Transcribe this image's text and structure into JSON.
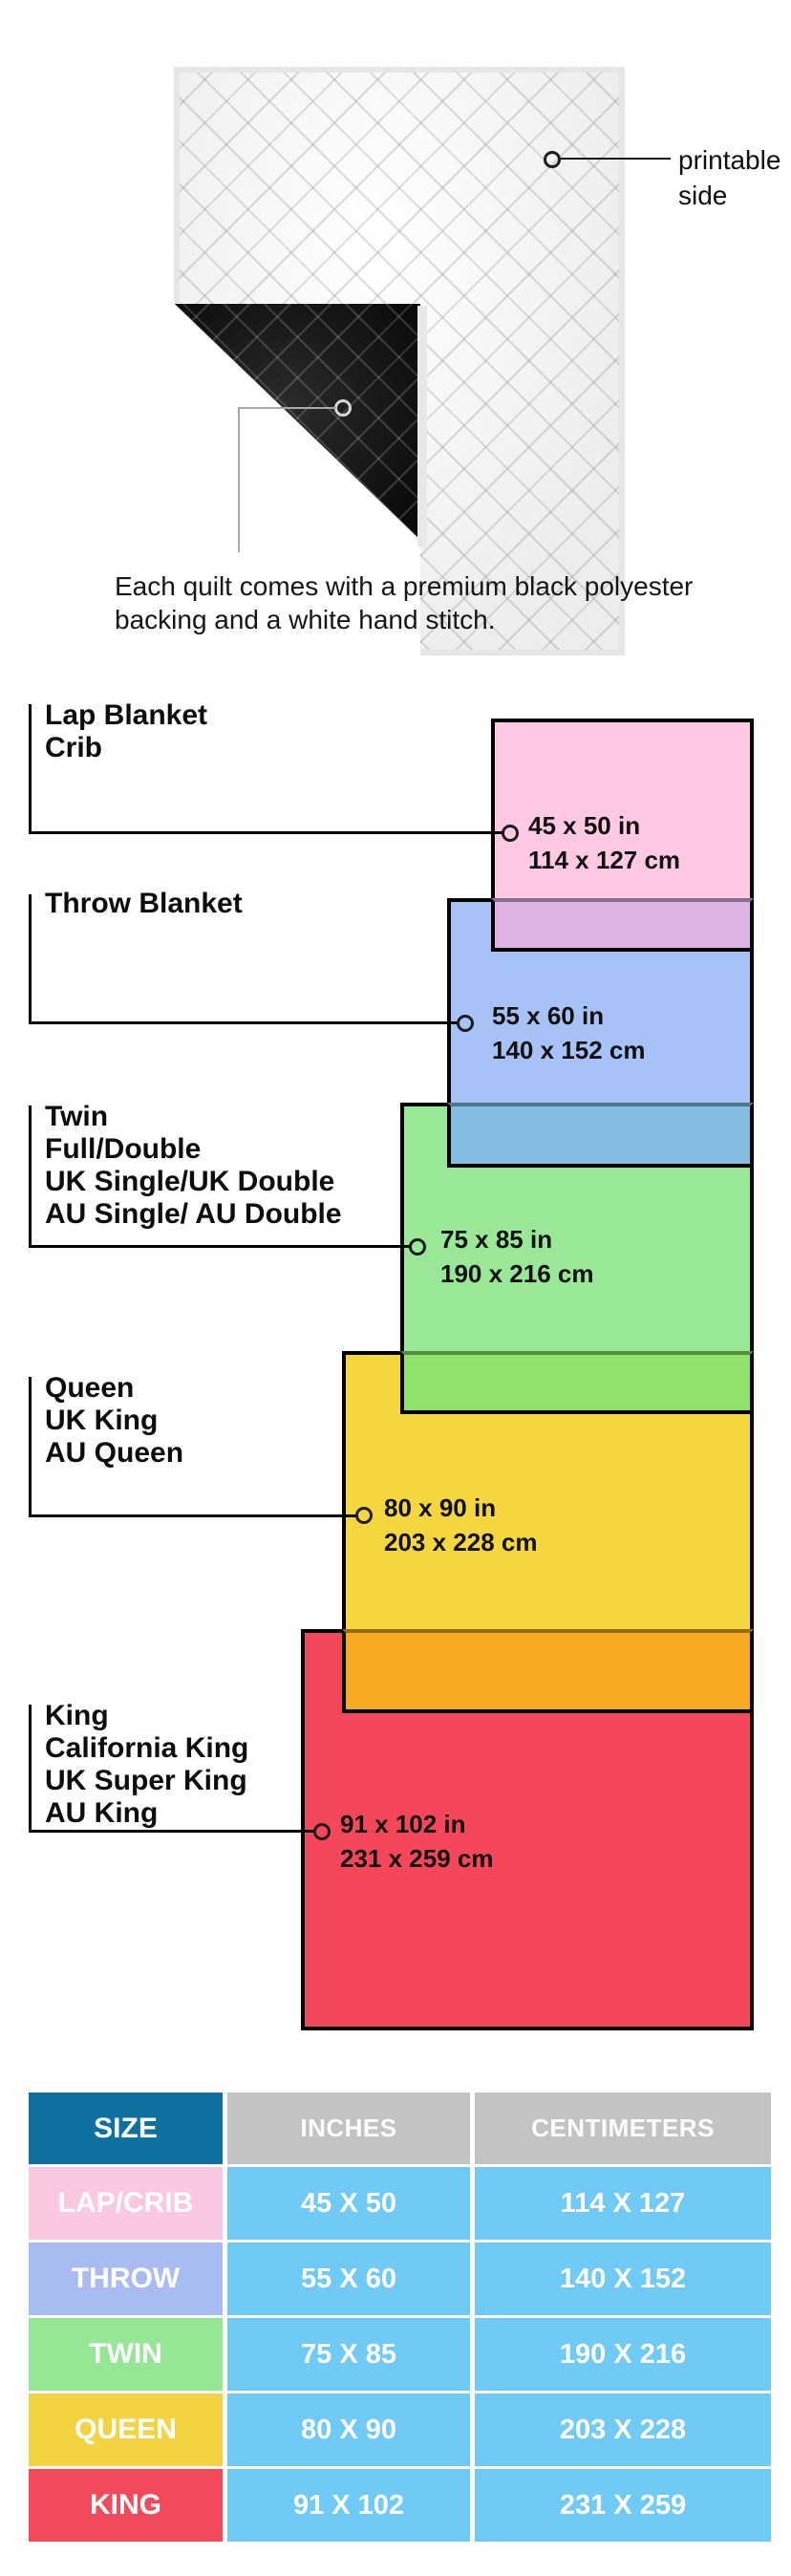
{
  "hero": {
    "printable_line1": "printable",
    "printable_line2": "side",
    "caption_line1": "Each quilt comes with a premium black polyester",
    "caption_line2": "backing and a white hand stitch."
  },
  "diagram": {
    "items": [
      {
        "name": "lap-crib",
        "labels": [
          "Lap Blanket",
          "Crib"
        ],
        "inches": "45 x 50 in",
        "cm": "114 x 127 cm",
        "fill": "#FFC8E3",
        "overlap_fill": "#DCB3E3"
      },
      {
        "name": "throw",
        "labels": [
          "Throw Blanket"
        ],
        "inches": "55 x 60 in",
        "cm": "140 x 152 cm",
        "fill": "#A7C2F6",
        "overlap_fill": "#83BDDF"
      },
      {
        "name": "twin",
        "labels": [
          "Twin",
          "Full/Double",
          "UK Single/UK Double",
          "AU Single/ AU Double"
        ],
        "inches": "75 x 85 in",
        "cm": "190 x 216 cm",
        "fill": "#98E897",
        "overlap_fill": "#8FE16B"
      },
      {
        "name": "queen",
        "labels": [
          "Queen",
          "UK King",
          "AU Queen"
        ],
        "inches": "80 x 90 in",
        "cm": "203 x 228 cm",
        "fill": "#F4D73E",
        "overlap_fill": "#F5AB21"
      },
      {
        "name": "king",
        "labels": [
          "King",
          "California King",
          "UK Super King",
          "AU King"
        ],
        "inches": "91 x 102 in",
        "cm": "231 x 259 cm",
        "fill": "#F4485A",
        "overlap_fill": null
      }
    ]
  },
  "size_table": {
    "headers": [
      "SIZE",
      "INCHES",
      "CENTIMETERS"
    ],
    "size_header_bg": "#0F719F",
    "metric_header_bg": "#C3C3C3",
    "value_bg": "#6FCBF5",
    "rows": [
      {
        "size": "LAP/CRIB",
        "inches": "45 X 50",
        "centimeters": "114 X 127",
        "color": "#FAC8E1"
      },
      {
        "size": "THROW",
        "inches": "55 X 60",
        "centimeters": "140 X 152",
        "color": "#A8BCF2"
      },
      {
        "size": "TWIN",
        "inches": "75 X 85",
        "centimeters": "190 X 216",
        "color": "#95E795"
      },
      {
        "size": "QUEEN",
        "inches": "80 X 90",
        "centimeters": "203 X 228",
        "color": "#F3D341"
      },
      {
        "size": "KING",
        "inches": "91 X 102",
        "centimeters": "231 X 259",
        "color": "#F34A5B"
      }
    ]
  }
}
